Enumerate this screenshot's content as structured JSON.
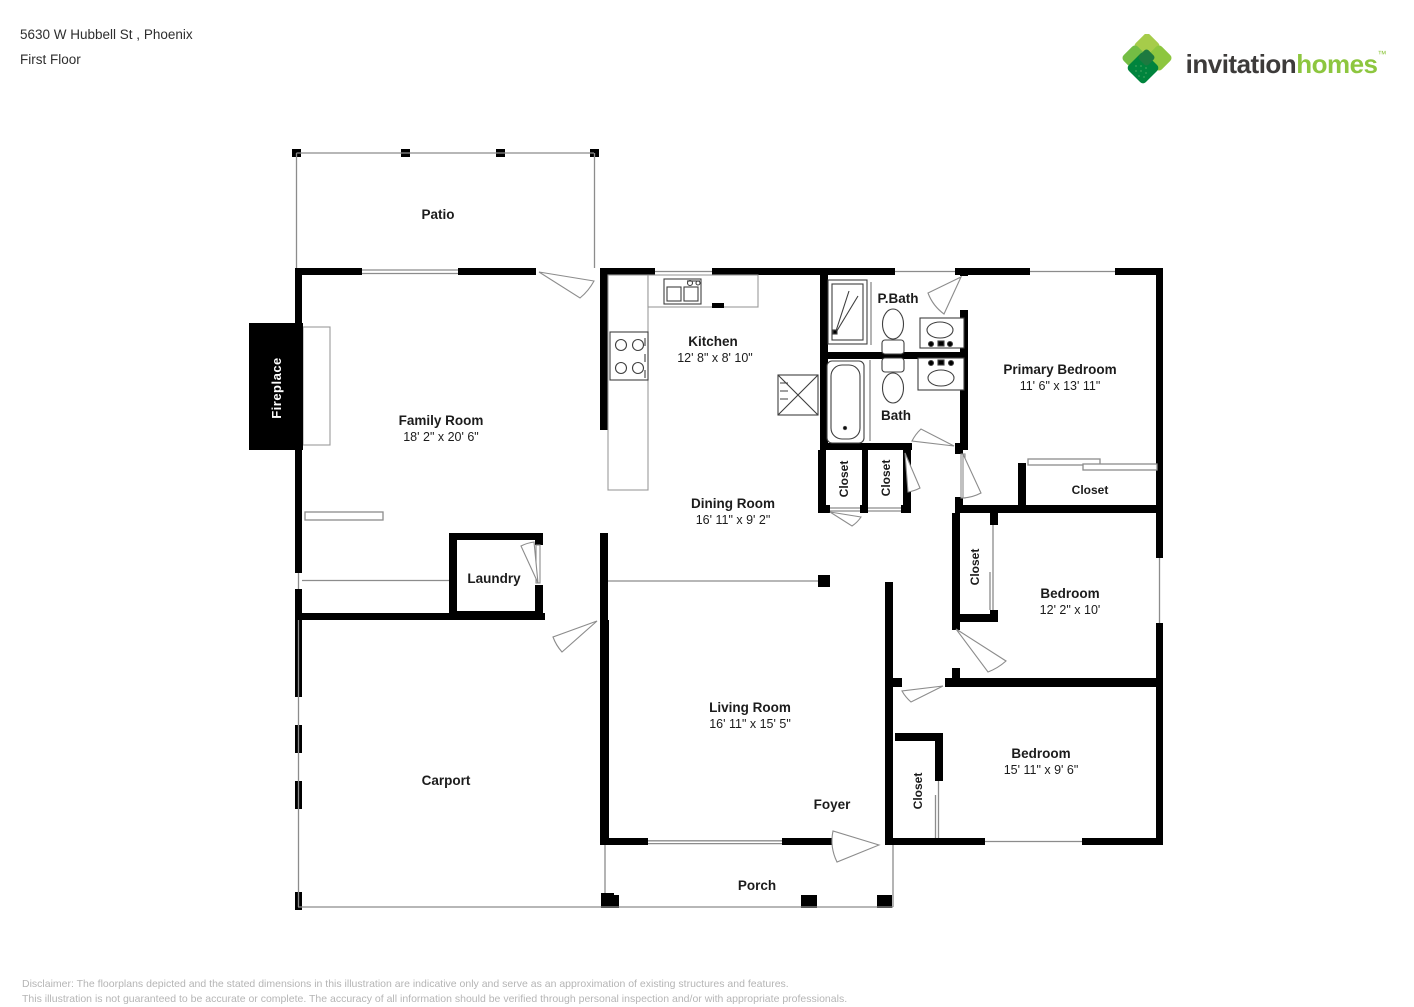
{
  "header": {
    "address": "5630 W Hubbell St , Phoenix",
    "floor": "First Floor"
  },
  "logo": {
    "icon_name": "invitation-homes-diamond-logo",
    "brand_first": "invitation",
    "brand_second": "homes",
    "mark": "™",
    "colors": {
      "dark_text": "#3d3b3a",
      "green_text": "#8dc63f",
      "leaf_light": "#a6cc4a",
      "leaf_mid": "#8dc63f",
      "leaf_mid2": "#74bd44",
      "leaf_dark": "#00843d",
      "leaf_center": "#1d7a40"
    }
  },
  "rooms": {
    "patio": {
      "name": "Patio"
    },
    "family_room": {
      "name": "Family Room",
      "dims": "18' 2\" x 20' 6\""
    },
    "kitchen": {
      "name": "Kitchen",
      "dims": "12' 8\" x 8' 10\""
    },
    "pbath": {
      "name": "P.Bath"
    },
    "bath": {
      "name": "Bath"
    },
    "primary_bedroom": {
      "name": "Primary Bedroom",
      "dims": "11' 6\" x 13' 11\""
    },
    "dining_room": {
      "name": "Dining Room",
      "dims": "16' 11\" x 9' 2\""
    },
    "laundry": {
      "name": "Laundry"
    },
    "living_room": {
      "name": "Living Room",
      "dims": "16' 11\" x 15' 5\""
    },
    "bedroom_mid": {
      "name": "Bedroom",
      "dims": "12' 2\" x 10'"
    },
    "bedroom_bottom": {
      "name": "Bedroom",
      "dims": "15' 11\" x 9' 6\""
    },
    "carport": {
      "name": "Carport"
    },
    "foyer": {
      "name": "Foyer"
    },
    "porch": {
      "name": "Porch"
    },
    "fireplace": {
      "name": "Fireplace"
    }
  },
  "labels": {
    "closet": "Closet"
  },
  "footer": {
    "line1": "Disclaimer: The floorplans depicted and the stated dimensions in this illustration are indicative only and serve as an approximation of existing structures and features.",
    "line2": "This illustration is not guaranteed to be accurate or complete. The accuracy of all information should be verified through personal inspection and/or with appropriate professionals."
  }
}
